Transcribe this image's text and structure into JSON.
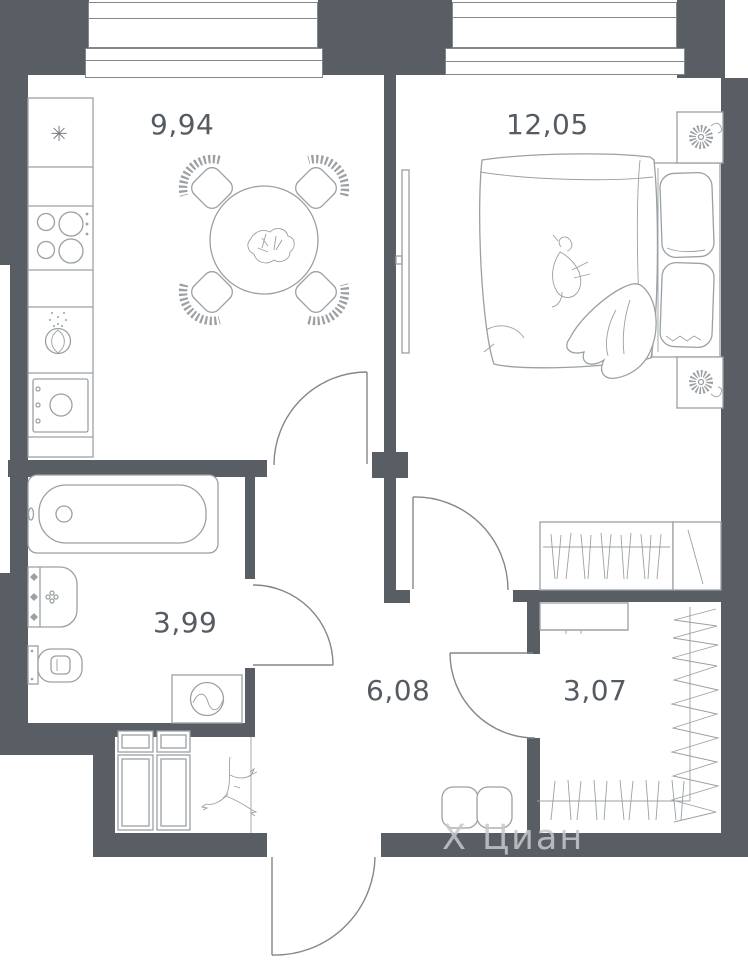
{
  "rooms": {
    "kitchen": {
      "label": "9,94"
    },
    "bedroom": {
      "label": "12,05"
    },
    "bathroom": {
      "label": "3,99"
    },
    "hallway": {
      "label": "6,08"
    },
    "closet": {
      "label": "3,07"
    }
  },
  "watermark": {
    "mark": "Х",
    "text": "Циан"
  },
  "icons": {
    "snowflake": "✳"
  },
  "colors": {
    "wall": "#585e64",
    "line": "#9aa0a4",
    "line_dark": "#82878c",
    "label": "#555b62",
    "watermark": "#c6c9cc",
    "background": "#ffffff"
  }
}
